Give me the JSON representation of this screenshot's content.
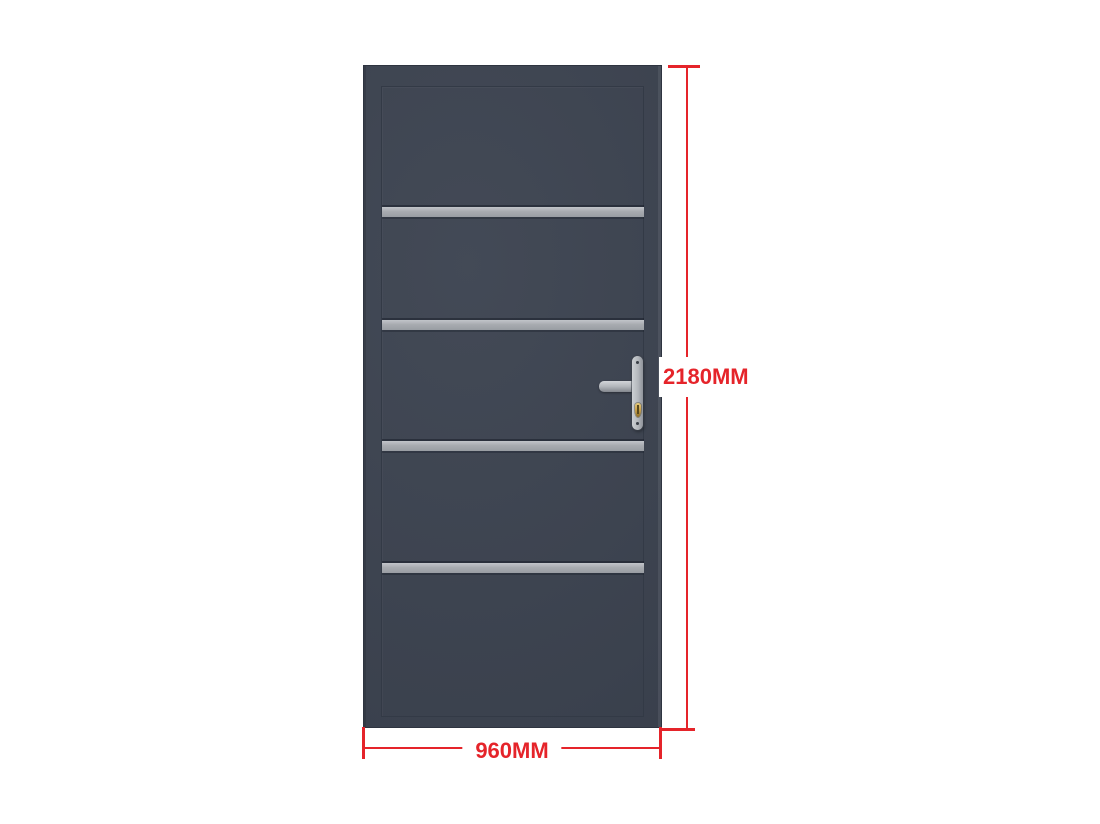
{
  "diagram": {
    "type": "door-dimension-diagram",
    "door": {
      "face_color": "#3c4350",
      "edge_color": "#2e3440",
      "panel_outline_color": "#333a46",
      "stripe_color": "#a8abb0",
      "stripe_count": 4,
      "handle": {
        "plate_color": "#b3b7bc",
        "lever_color": "#b2b6bb",
        "cylinder_color": "#c9a14b"
      }
    },
    "dimensions": {
      "color": "#e5242a",
      "height": {
        "label": "2180MM"
      },
      "width": {
        "label": "960MM"
      }
    }
  }
}
